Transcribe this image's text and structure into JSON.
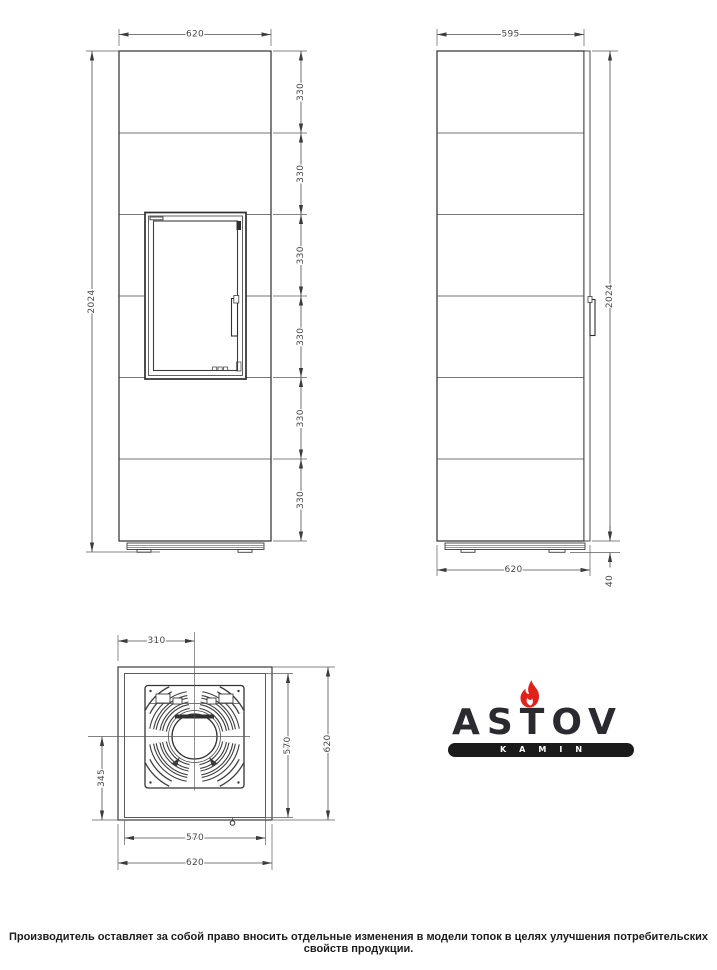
{
  "drawing": {
    "front_view": {
      "width_label": "620",
      "height_label": "2024",
      "segment_labels": [
        "330",
        "330",
        "330",
        "330",
        "330",
        "330"
      ]
    },
    "side_view": {
      "depth_label": "595",
      "height_label": "2024",
      "base_depth_label": "620",
      "base_height_label": "40"
    },
    "top_view": {
      "flue_offset_label": "310",
      "flue_to_front_label": "345",
      "inner_width_label": "570",
      "outer_width_label": "620",
      "inner_depth_label": "570",
      "outer_depth_label": "620"
    }
  },
  "logo": {
    "brand": "ASTOV",
    "subtitle": "KAMIN",
    "brand_color": "#2a2a30",
    "flame_color": "#e2211a",
    "bar_color": "#1b1b1b",
    "subtitle_color": "#ffffff"
  },
  "footer": {
    "disclaimer": "Производитель оставляет за собой право вносить отдельные изменения в модели топок в целях улучшения потребительских свойств продукции."
  },
  "colors": {
    "background": "#ffffff",
    "line": "#3c3c3c",
    "dimension": "#4c4c4c"
  }
}
